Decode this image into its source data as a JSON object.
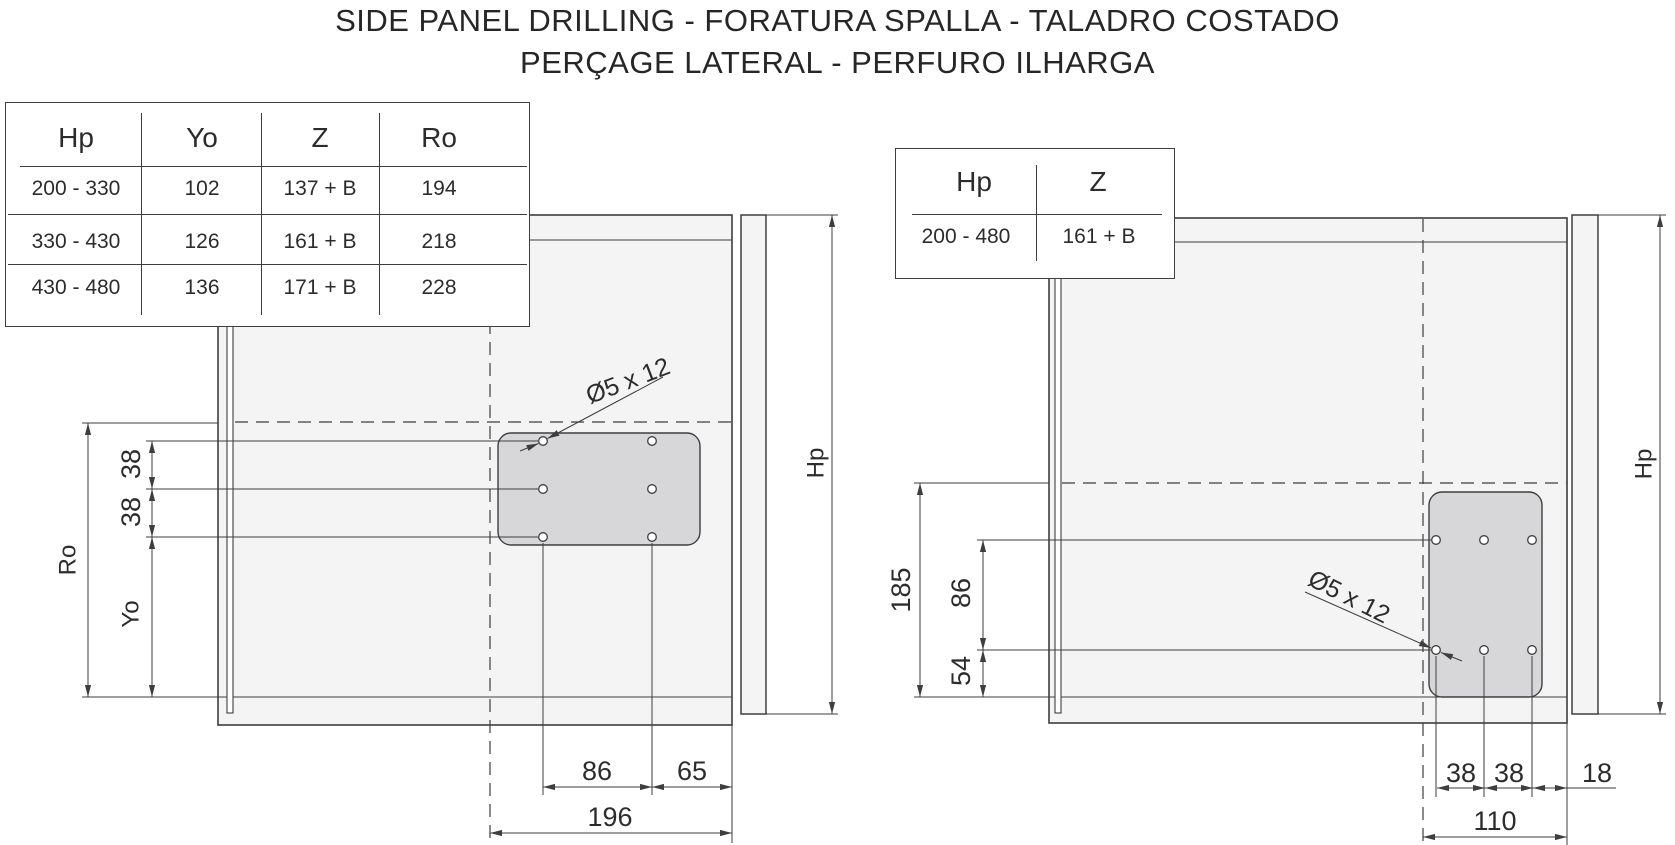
{
  "title": {
    "line1": "SIDE PANEL DRILLING - FORATURA SPALLA - TALADRO COSTADO",
    "line2": "PERÇAGE LATERAL - PERFURO ILHARGA"
  },
  "left_view": {
    "table": {
      "headers": [
        "Hp",
        "Yo",
        "Z",
        "Ro"
      ],
      "rows": [
        [
          "200 - 330",
          "102",
          "137 + B",
          "194"
        ],
        [
          "330 - 430",
          "126",
          "161 + B",
          "218"
        ],
        [
          "430 - 480",
          "136",
          "171 + B",
          "228"
        ]
      ]
    },
    "labels": {
      "hole": "Ø5 x 12",
      "d38a": "38",
      "d38b": "38",
      "yo": "Yo",
      "ro": "Ro",
      "hp": "Hp",
      "d86": "86",
      "d65": "65",
      "d196": "196"
    }
  },
  "right_view": {
    "table": {
      "headers": [
        "Hp",
        "Z"
      ],
      "rows": [
        [
          "200 - 480",
          "161 + B"
        ]
      ]
    },
    "labels": {
      "hole": "Ø5 x 12",
      "d185": "185",
      "d86": "86",
      "d54": "54",
      "hp": "Hp",
      "d38a": "38",
      "d38b": "38",
      "d18": "18",
      "d110": "110"
    }
  },
  "colors": {
    "line": "#3e3e3e",
    "panel_fill": "#f4f4f5",
    "plate_fill": "#d7d7d9",
    "text": "#2c2c2c",
    "background": "#ffffff"
  }
}
